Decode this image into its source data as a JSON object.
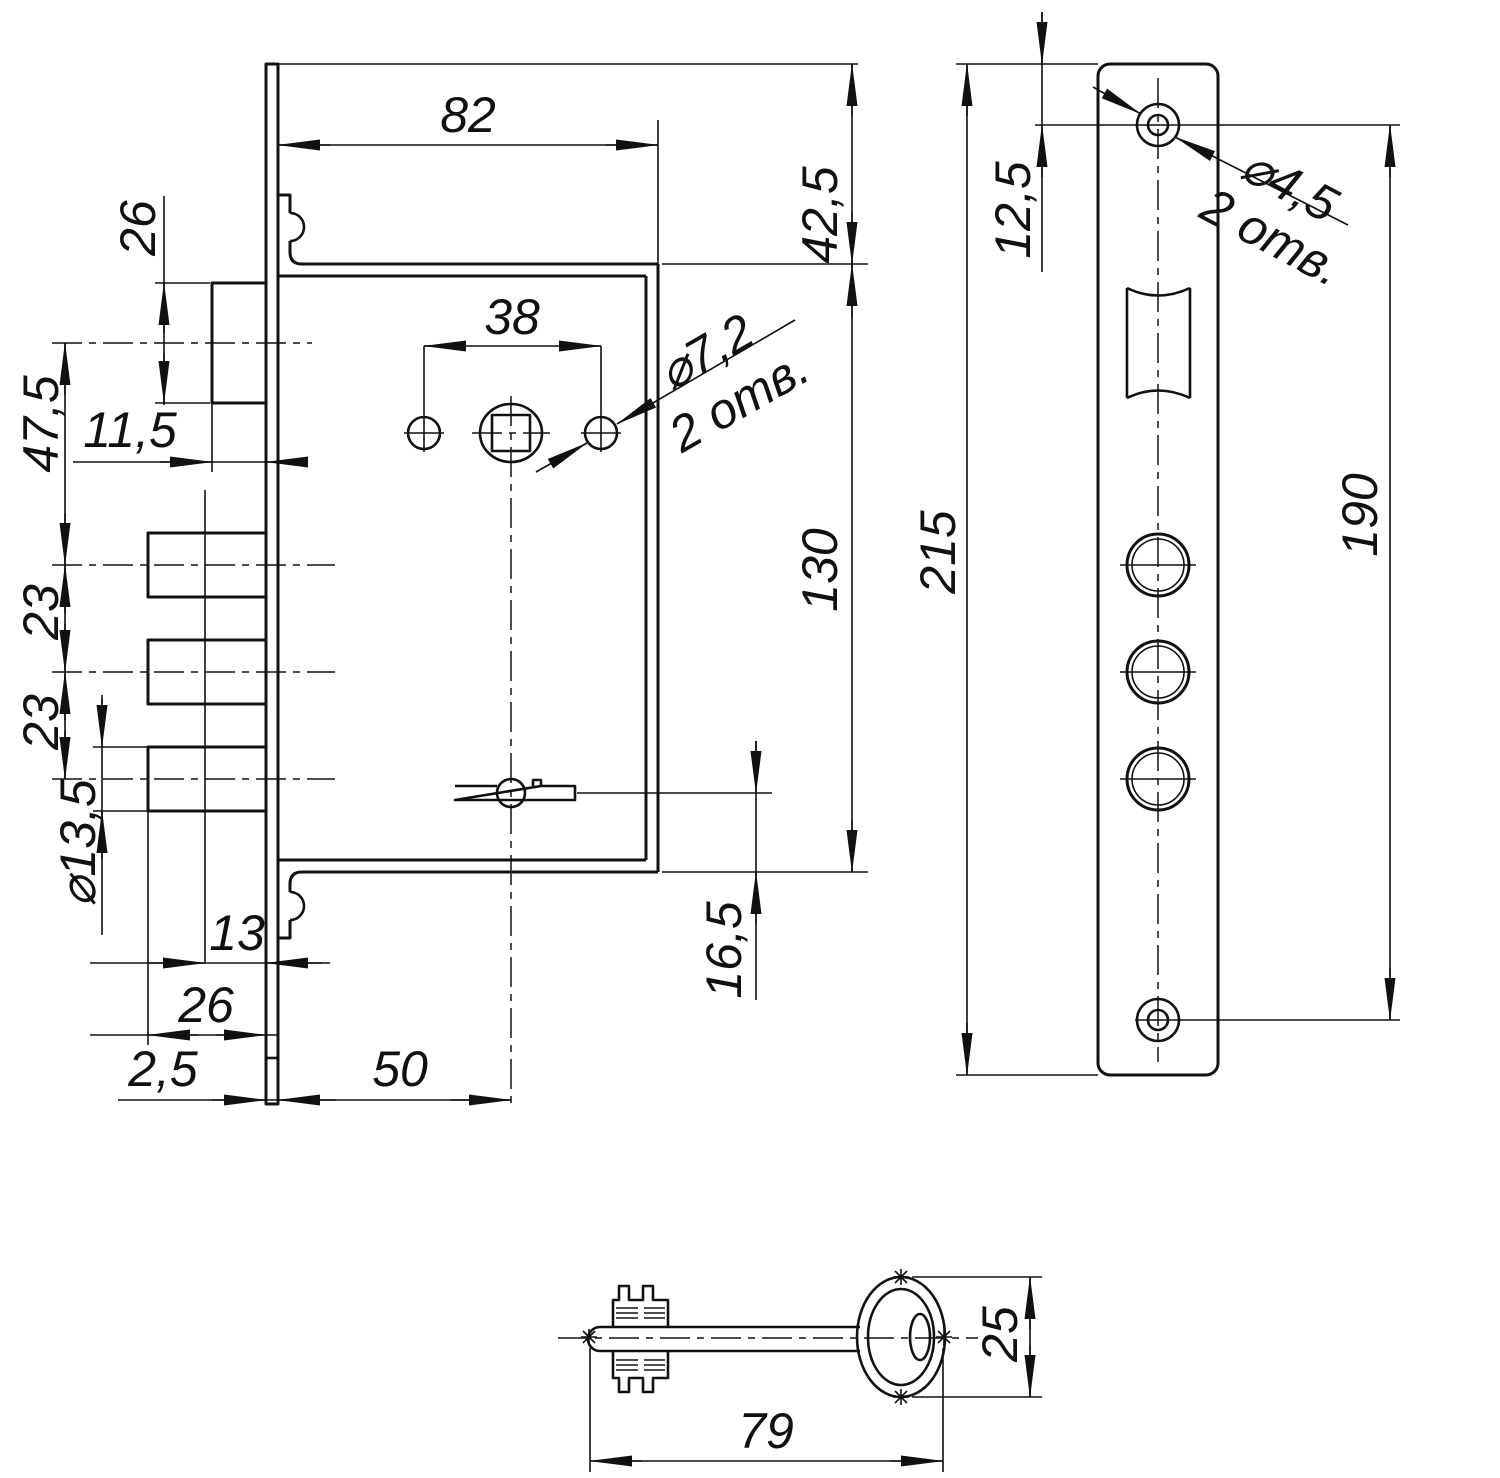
{
  "drawing": {
    "kind": "technical-drawing",
    "subject": "mortise deadbolt lock, faceplate and key",
    "line_color": "#111111",
    "background": "#ffffff"
  },
  "dims": {
    "case_depth": "82",
    "top_offset": "42,5",
    "latch_height": "26",
    "spindle_hole_span": "38",
    "fix_hole_dia": "⌀7,2",
    "fix_hole_qty": "2 отв.",
    "latch_to_bolt": "47,5",
    "latch_protrusion": "11,5",
    "bolt_pitch_1": "23",
    "bolt_pitch_2": "23",
    "bolt_dia": "⌀13,5",
    "bolt_step": "13",
    "bolt_throw": "26",
    "plate_thickness": "2,5",
    "backset": "50",
    "case_height": "130",
    "lever_offset": "16,5",
    "screw_top_offset": "12,5",
    "plate_length": "215",
    "screw_pitch": "190",
    "screw_hole_dia": "⌀4,5",
    "screw_hole_qty": "2 отв.",
    "key_length": "79",
    "key_bow_width": "25"
  }
}
